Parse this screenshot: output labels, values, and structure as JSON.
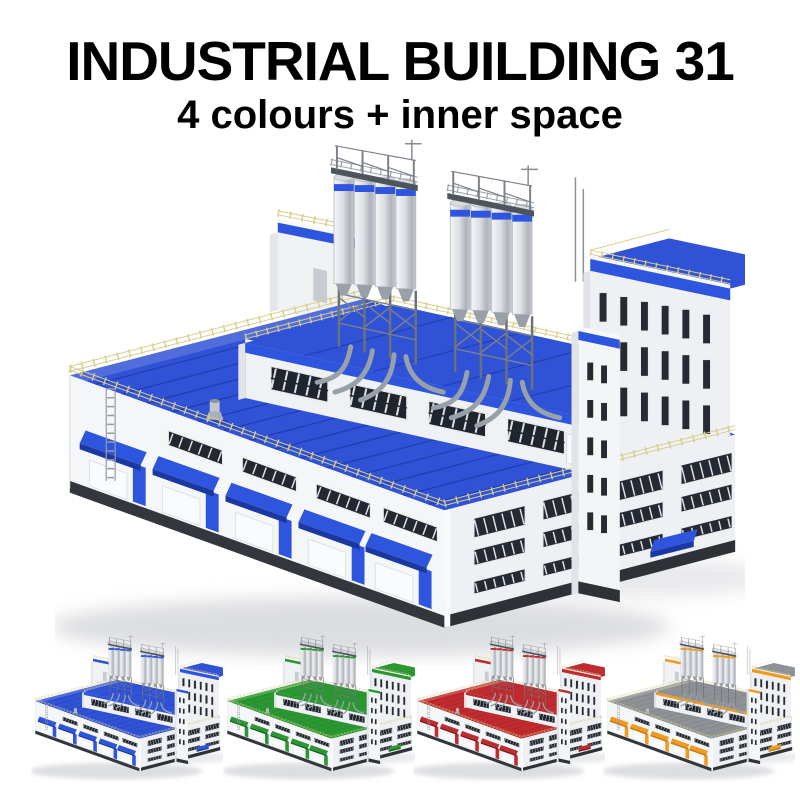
{
  "header": {
    "title": "INDUSTRIAL BUILDING 31",
    "subtitle": "4 colours + inner space"
  },
  "main_render": {
    "subject": "industrial building with rooftop silos",
    "variant_shown": "blue"
  },
  "variants": [
    {
      "name": "blue",
      "roof": "#3052d6",
      "roof_dark": "#1f3cab",
      "roof_light": "#4a69e8",
      "accent": "#2e55dd",
      "accent_dark": "#1b38a0"
    },
    {
      "name": "green",
      "roof": "#2b9733",
      "roof_dark": "#1c7a24",
      "roof_light": "#3cb04a",
      "accent": "#2b9733",
      "accent_dark": "#156318"
    },
    {
      "name": "red",
      "roof": "#bf2b2e",
      "roof_dark": "#971d20",
      "roof_light": "#d2403f",
      "accent": "#bf2b2e",
      "accent_dark": "#7f1518"
    },
    {
      "name": "grey-orange",
      "roof": "#8e9296",
      "roof_dark": "#717579",
      "roof_light": "#a5a9ad",
      "accent": "#f09a20",
      "accent_dark": "#c4790f"
    }
  ]
}
